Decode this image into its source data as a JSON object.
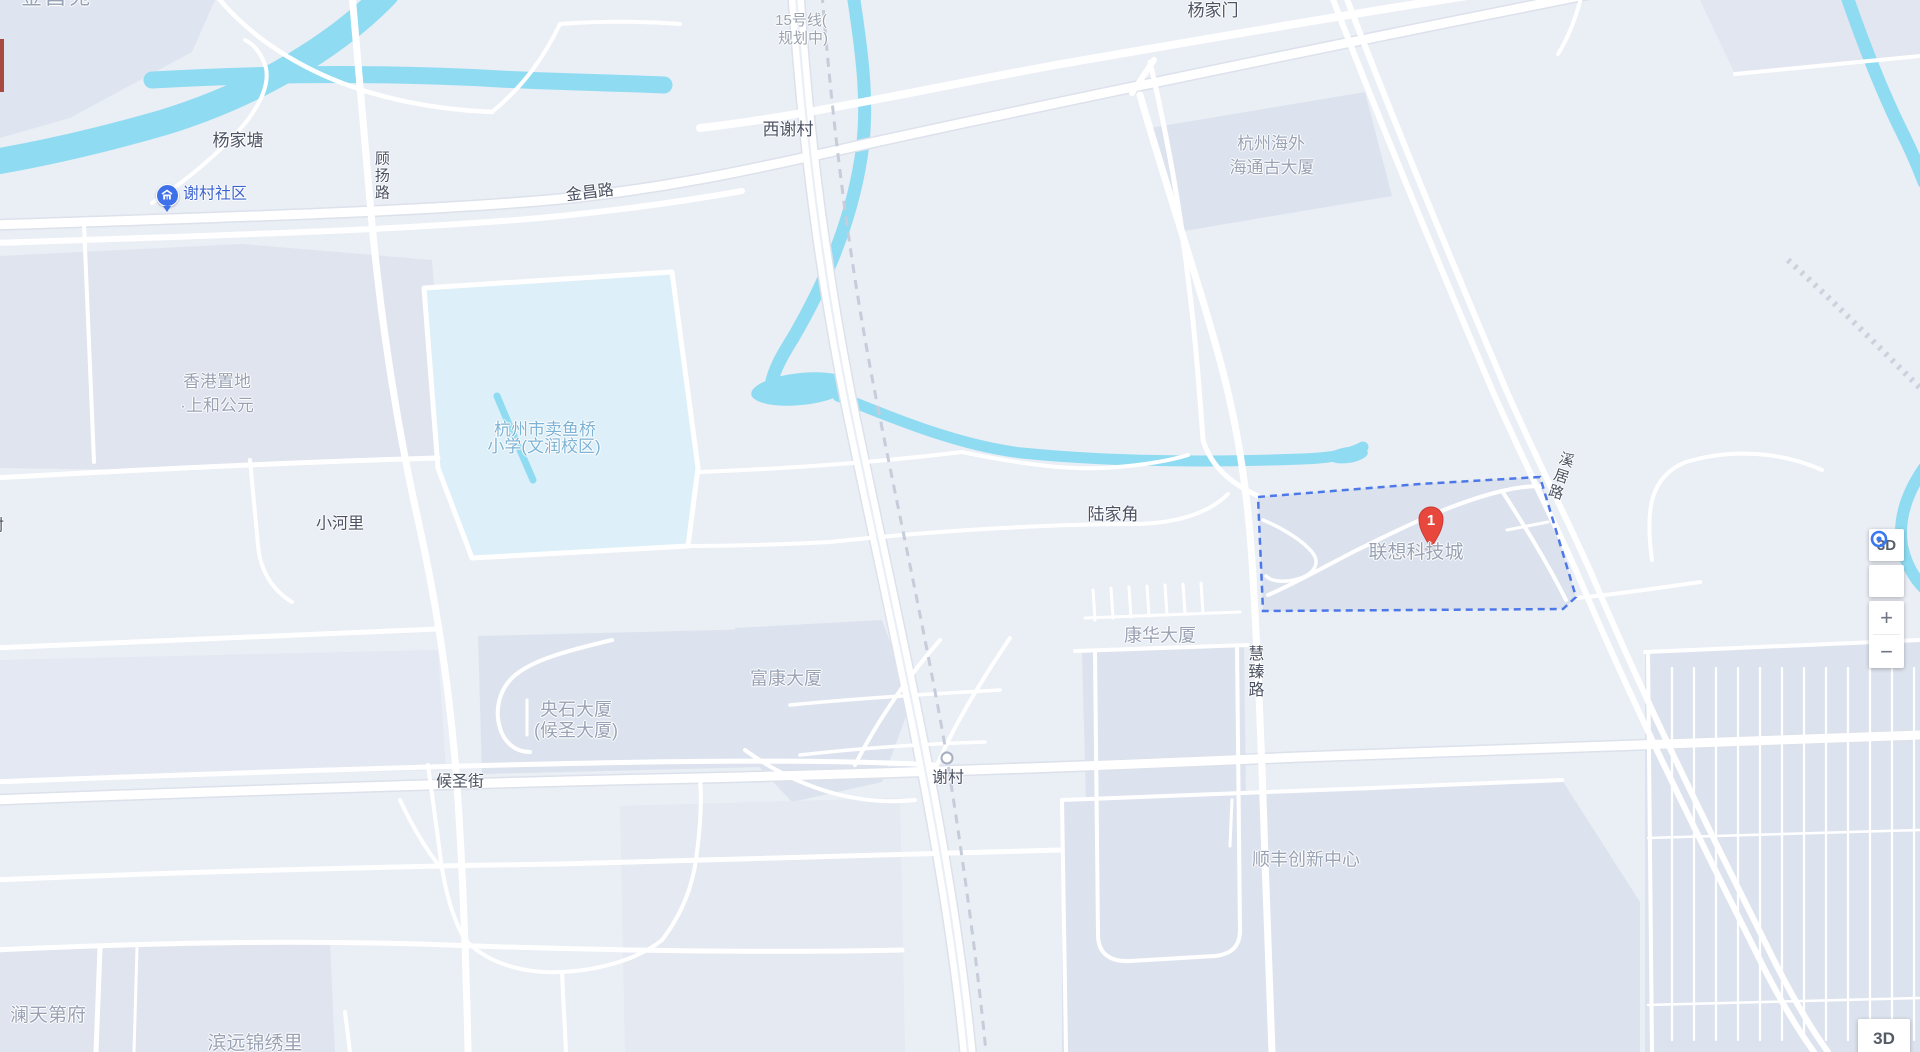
{
  "map": {
    "background_color": "#eaeef5",
    "water_color": "#8fdbf2",
    "building_color": "#dde3ee",
    "road_color": "#ffffff",
    "selection_outline_color": "#4d79e8",
    "marker": {
      "label": "1",
      "color": "#e8473d"
    },
    "poi_icon": "community-building-icon",
    "station_marker": "xiecun-planned-station",
    "labels": [
      {
        "id": "jinchangyuan",
        "text": "金昌苑",
        "x": 57,
        "y": -2,
        "size": 21,
        "type": "building",
        "ls": 3
      },
      {
        "id": "yangjiatang",
        "text": "杨家塘",
        "x": 238,
        "y": 141,
        "size": 17,
        "type": "place"
      },
      {
        "id": "xiecun-shequ",
        "text": "谢村社区",
        "x": 215,
        "y": 195,
        "size": 16,
        "type": "poi"
      },
      {
        "id": "guyang-road",
        "text": "顾扬路",
        "x": 381,
        "y": 176,
        "size": 15,
        "type": "road",
        "vertical": true
      },
      {
        "id": "jinchang-road",
        "text": "金昌路",
        "x": 590,
        "y": 194,
        "size": 16,
        "type": "road",
        "rotate": -7
      },
      {
        "id": "xixiecun",
        "text": "西谢村",
        "x": 788,
        "y": 130,
        "size": 17,
        "type": "place"
      },
      {
        "id": "line15-1",
        "text": "15号线(",
        "x": 801,
        "y": 21,
        "size": 15,
        "type": "planned"
      },
      {
        "id": "line15-2",
        "text": "规划中)",
        "x": 803,
        "y": 39,
        "size": 15,
        "type": "planned"
      },
      {
        "id": "yangjiamen",
        "text": "杨家门",
        "x": 1213,
        "y": 11,
        "size": 17,
        "type": "place"
      },
      {
        "id": "haitonggu-1",
        "text": "杭州海外",
        "x": 1271,
        "y": 144,
        "size": 17,
        "type": "building"
      },
      {
        "id": "haitonggu-2",
        "text": "海通古大厦",
        "x": 1272,
        "y": 168,
        "size": 17,
        "type": "building"
      },
      {
        "id": "shanghe-1",
        "text": "香港置地",
        "x": 217,
        "y": 382,
        "size": 17,
        "type": "building"
      },
      {
        "id": "shanghe-2",
        "text": "·上和公元",
        "x": 217,
        "y": 406,
        "size": 17,
        "type": "building"
      },
      {
        "id": "school-1",
        "text": "杭州市卖鱼桥",
        "x": 545,
        "y": 430,
        "size": 17,
        "type": "school"
      },
      {
        "id": "school-2",
        "text": "小学(文润校区)",
        "x": 544,
        "y": 447,
        "size": 17,
        "type": "school"
      },
      {
        "id": "xiaoheli",
        "text": "小河里",
        "x": 340,
        "y": 525,
        "size": 16,
        "type": "place"
      },
      {
        "id": "cun-clipped",
        "text": "村",
        "x": -4,
        "y": 527,
        "size": 16,
        "type": "place"
      },
      {
        "id": "lujiajiao",
        "text": "陆家角",
        "x": 1113,
        "y": 515,
        "size": 17,
        "type": "place"
      },
      {
        "id": "lenovo-city",
        "text": "联想科技城",
        "x": 1416,
        "y": 553,
        "size": 19,
        "type": "building"
      },
      {
        "id": "xiju-road",
        "text": "溪居路",
        "x": 1560,
        "y": 476,
        "size": 15,
        "type": "road",
        "vertical": true,
        "rotate": 18
      },
      {
        "id": "kanghua",
        "text": "康华大厦",
        "x": 1160,
        "y": 636,
        "size": 18,
        "type": "building"
      },
      {
        "id": "huizhen-road",
        "text": "慧臻路",
        "x": 1253,
        "y": 672,
        "size": 16,
        "type": "road",
        "vertical": true
      },
      {
        "id": "fukang",
        "text": "富康大厦",
        "x": 786,
        "y": 679,
        "size": 18,
        "type": "building"
      },
      {
        "id": "yangshi-1",
        "text": "央石大厦",
        "x": 576,
        "y": 710,
        "size": 18,
        "type": "building"
      },
      {
        "id": "yangshi-2",
        "text": "(候圣大厦)",
        "x": 576,
        "y": 731,
        "size": 18,
        "type": "building"
      },
      {
        "id": "housheng-street",
        "text": "候圣街",
        "x": 460,
        "y": 783,
        "size": 16,
        "type": "road"
      },
      {
        "id": "xiecun",
        "text": "谢村",
        "x": 948,
        "y": 779,
        "size": 16,
        "type": "place"
      },
      {
        "id": "sf-center",
        "text": "顺丰创新中心",
        "x": 1306,
        "y": 860,
        "size": 18,
        "type": "building"
      },
      {
        "id": "lantian",
        "text": "澜天第府",
        "x": 48,
        "y": 1016,
        "size": 19,
        "type": "building"
      },
      {
        "id": "binyuan",
        "text": "滨远锦绣里",
        "x": 255,
        "y": 1044,
        "size": 19,
        "type": "building"
      }
    ]
  },
  "controls": {
    "view_3d": "3D",
    "zoom_in": "+",
    "zoom_out": "−",
    "bottom_3d": "3D"
  }
}
